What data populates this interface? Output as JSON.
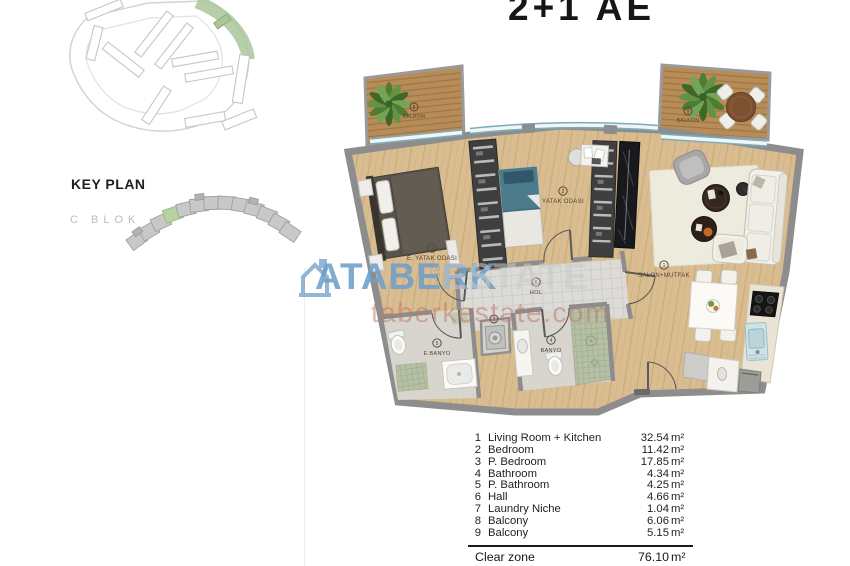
{
  "title": "2+1 AE",
  "key_plan": {
    "heading": "KEY PLAN",
    "block_label": "C BLOK"
  },
  "watermark": {
    "brand": "ATABERK",
    "brand_secondary": "ESTATE",
    "vertical_text": "REAL",
    "url": "taberkestate.com",
    "brand_color": "#6f9fc9"
  },
  "floor_plan": {
    "rooms": [
      {
        "num": "8",
        "label": "BALKON"
      },
      {
        "num": "9",
        "label": "BALKON"
      },
      {
        "num": "3",
        "label": "E. YATAK ODASI"
      },
      {
        "num": "2",
        "label": "YATAK ODASI"
      },
      {
        "num": "1",
        "label": "SALON+MUTFAK"
      },
      {
        "num": "6",
        "label": "HOL"
      },
      {
        "num": "5",
        "label": "E.BANYO"
      },
      {
        "num": "4",
        "label": "BANYO"
      },
      {
        "num": "7",
        "label": ""
      }
    ]
  },
  "area_table": {
    "unit": "m²",
    "rows": [
      {
        "no": "1",
        "name": "Living Room + Kitchen",
        "area": "32.54"
      },
      {
        "no": "2",
        "name": "Bedroom",
        "area": "11.42"
      },
      {
        "no": "3",
        "name": "P. Bedroom",
        "area": "17.85"
      },
      {
        "no": "4",
        "name": "Bathroom",
        "area": "4.34"
      },
      {
        "no": "5",
        "name": "P. Bathroom",
        "area": "4.25"
      },
      {
        "no": "6",
        "name": "Hall",
        "area": "4.66"
      },
      {
        "no": "7",
        "name": "Laundry Niche",
        "area": "1.04"
      },
      {
        "no": "8",
        "name": "Balcony",
        "area": "6.06"
      },
      {
        "no": "9",
        "name": "Balcony",
        "area": "5.15"
      }
    ],
    "summary": {
      "name": "Clear zone",
      "area": "76.10"
    }
  }
}
